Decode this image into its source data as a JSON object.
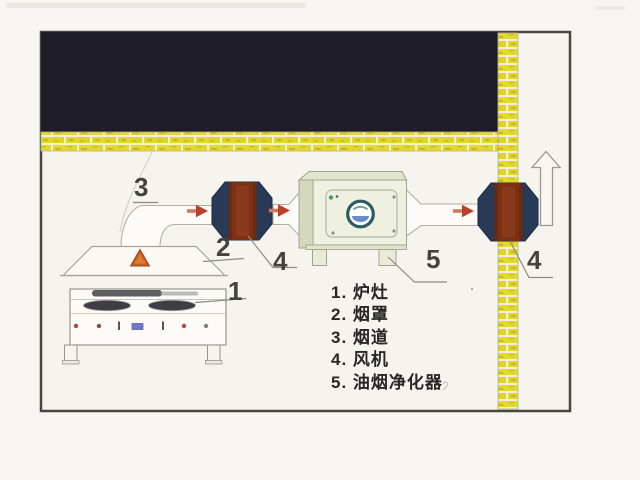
{
  "diagram": {
    "callouts": {
      "stove": "1",
      "hood": "2",
      "duct": "3",
      "fan": "4",
      "purifier": "5"
    },
    "legend": {
      "items": [
        "1. 炉灶",
        "2. 烟罩",
        "3. 烟道",
        "4. 风机",
        "5. 油烟净化器"
      ]
    },
    "colors": {
      "ceiling_black": "#1d1c27",
      "brick_yellow": "#e2d92f",
      "brick_mortar": "#f3efd6",
      "fan_housing_navy": "#293a56",
      "fan_core_brown": "#7a3116",
      "flow_arrow_red": "#bc3f2c",
      "heat_arrow_orange": "#c55f24",
      "purifier_cream": "#eef1df",
      "emblem_teal": "#2e5b63",
      "duct_outline_gray": "#b3afa4"
    },
    "icons": {
      "flow_arrow": "right-arrow-icon",
      "exhaust_outlet": "up-arrow-outline-icon",
      "heat_rise": "up-triangle-icon"
    }
  }
}
